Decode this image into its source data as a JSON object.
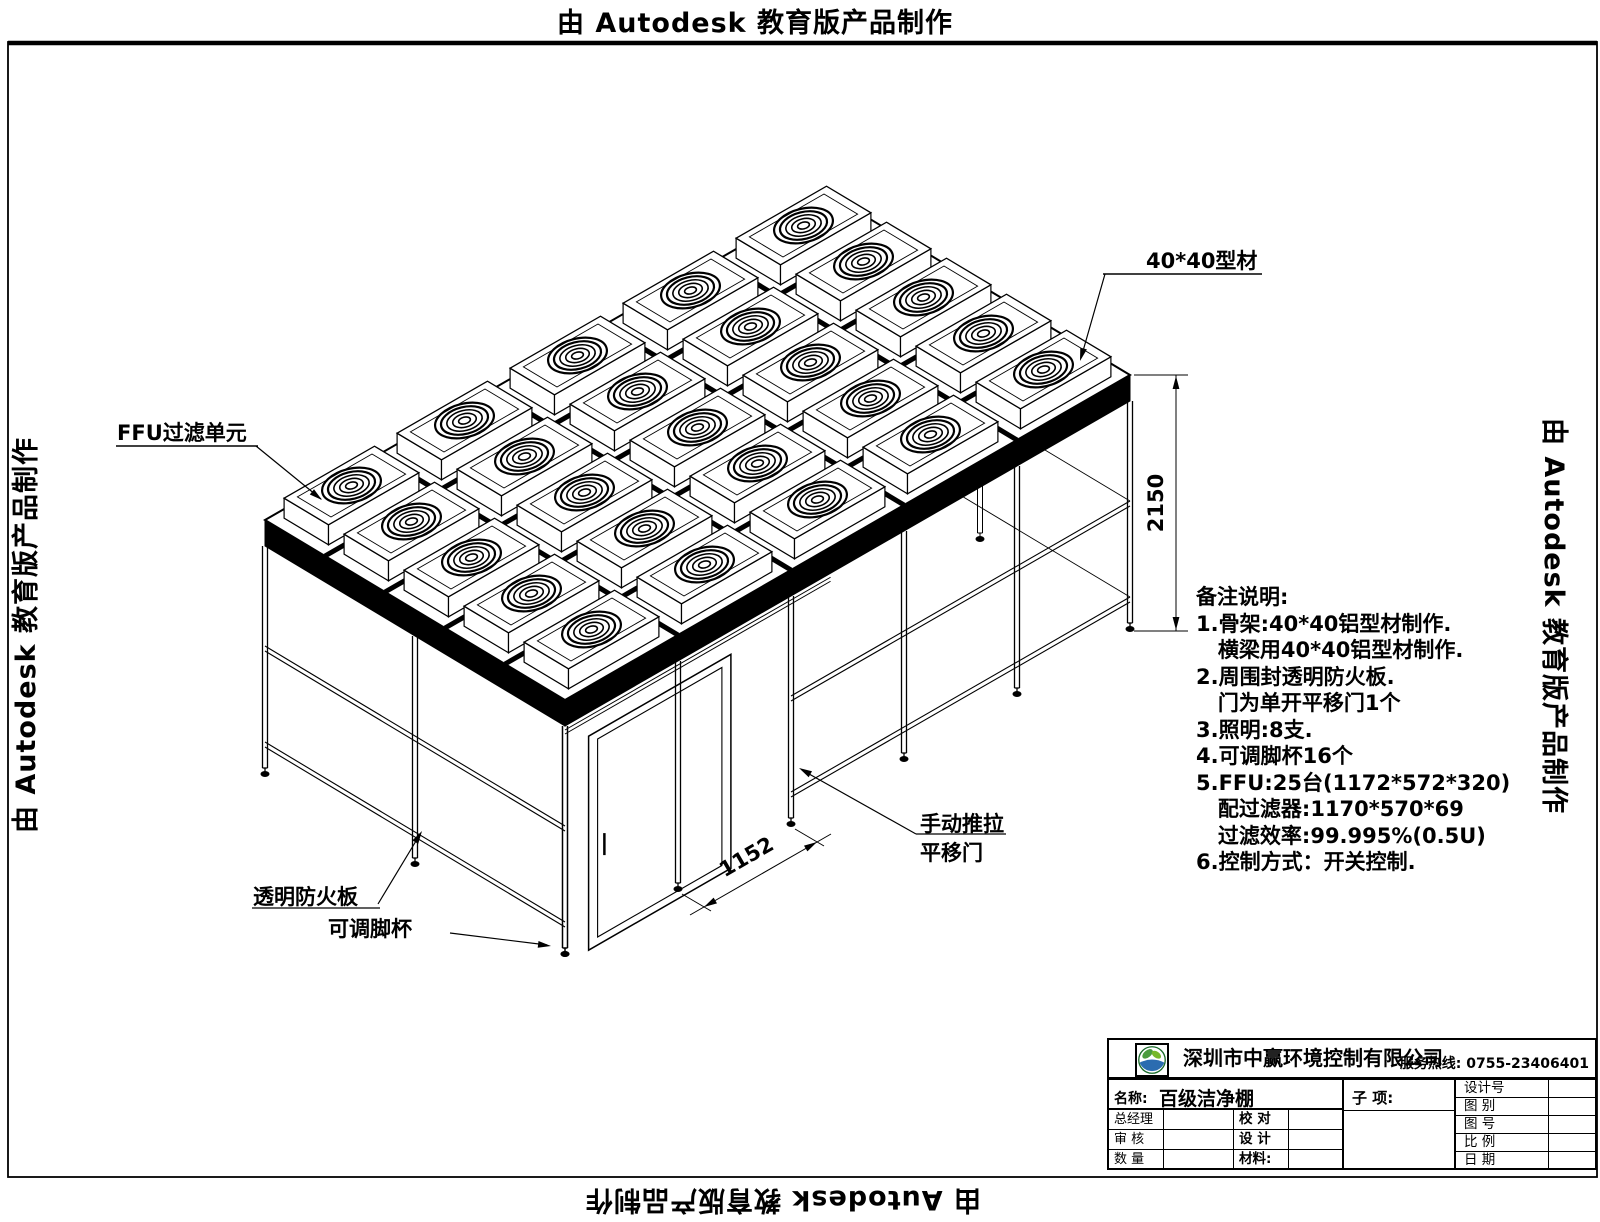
{
  "watermark": "由 Autodesk 教育版产品制作",
  "labels": {
    "ffu_unit": "FFU过滤单元",
    "profile": "40*40型材",
    "fire_panel": "透明防火板",
    "adjustable_foot": "可调脚杯",
    "door_line1": "手动推拉",
    "door_line2": "平移门"
  },
  "dimensions": {
    "height": "2150",
    "door_width": "1152"
  },
  "notes": [
    "备注说明:",
    "1.骨架:40*40铝型材制作.",
    "   横梁用40*40铝型材制作.",
    "2.周围封透明防火板.",
    "   门为单开平移门1个",
    "3.照明:8支.",
    "4.可调脚杯16个",
    "5.FFU:25台(1172*572*320)",
    "   配过滤器:1170*570*69",
    "   过滤效率:99.995%(0.5U)",
    "6.控制方式：开关控制."
  ],
  "titleblock": {
    "company": "深圳市中赢环境控制有限公司",
    "hotline": "服务热线: 0755-23406401",
    "name_label": "名称:",
    "name_value": "百级洁净棚",
    "subitem_label": "子  项:",
    "left_rows": {
      "gm": "总经理",
      "audit": "审  核",
      "qty": "数  量",
      "check": "校  对",
      "design": "设  计",
      "material": "材料:"
    },
    "right_rows": {
      "design_no": "设计号",
      "figure_type": "图  别",
      "figure_no": "图  号",
      "scale": "比  例",
      "date": "日  期"
    }
  }
}
